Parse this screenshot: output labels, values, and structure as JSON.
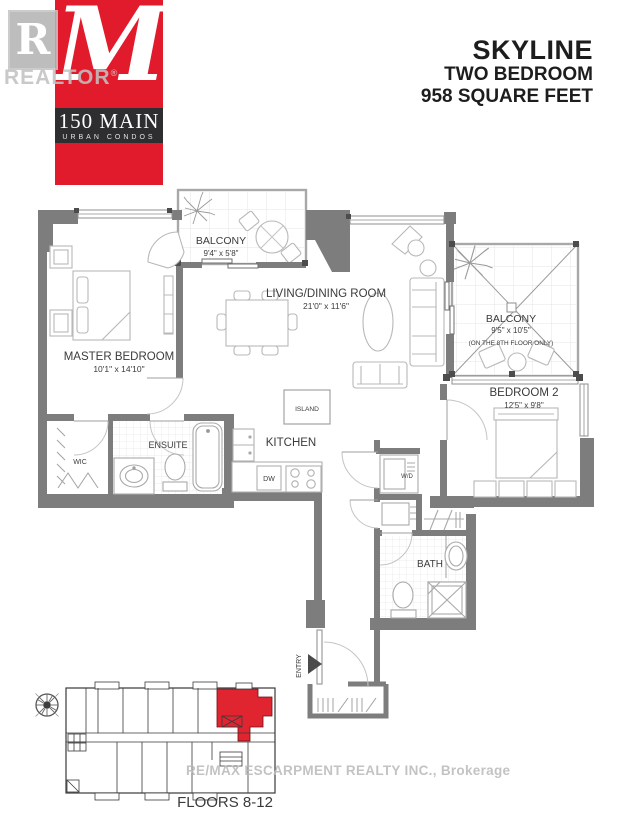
{
  "branding": {
    "watermark_letter": "R",
    "watermark_name": "REALTOR",
    "watermark_reg": "®",
    "logo_letter": "M",
    "logo_title": "150 MAIN",
    "logo_subtitle": "URBAN CONDOS"
  },
  "header": {
    "plan_name": "SKYLINE",
    "plan_type": "TWO BEDROOM",
    "plan_area": "958 SQUARE FEET"
  },
  "rooms": {
    "balcony1": {
      "label": "BALCONY",
      "dims": "9'4\" x 5'8\""
    },
    "living": {
      "label": "LIVING/DINING ROOM",
      "dims": "21'0\" x 11'6\""
    },
    "master": {
      "label": "MASTER BEDROOM",
      "dims": "10'1\" x 14'10\""
    },
    "balcony2": {
      "label": "BALCONY",
      "dims": "9'5\" x 10'5\"",
      "note": "(ON THE 8TH FLOOR ONLY)"
    },
    "bedroom2": {
      "label": "BEDROOM 2",
      "dims": "12'5\" x 9'8\""
    },
    "ensuite": {
      "label": "ENSUITE"
    },
    "wic": {
      "label": "WIC"
    },
    "kitchen": {
      "label": "KITCHEN"
    },
    "island": {
      "label": "ISLAND"
    },
    "dw": {
      "label": "DW"
    },
    "wd": {
      "label": "W/D"
    },
    "bath": {
      "label": "BATH"
    },
    "entry": {
      "label": "ENTRY"
    }
  },
  "keyplan": {
    "floors_label": "FLOORS 8-12"
  },
  "footer": {
    "watermark": "RE/MAX ESCARPMENT REALTY INC., Brokerage"
  },
  "colors": {
    "accent_red": "#e11b2b",
    "band_dark": "#2e2e30",
    "wall_gray": "#7d7d7d",
    "highlight_red": "#e02530"
  }
}
